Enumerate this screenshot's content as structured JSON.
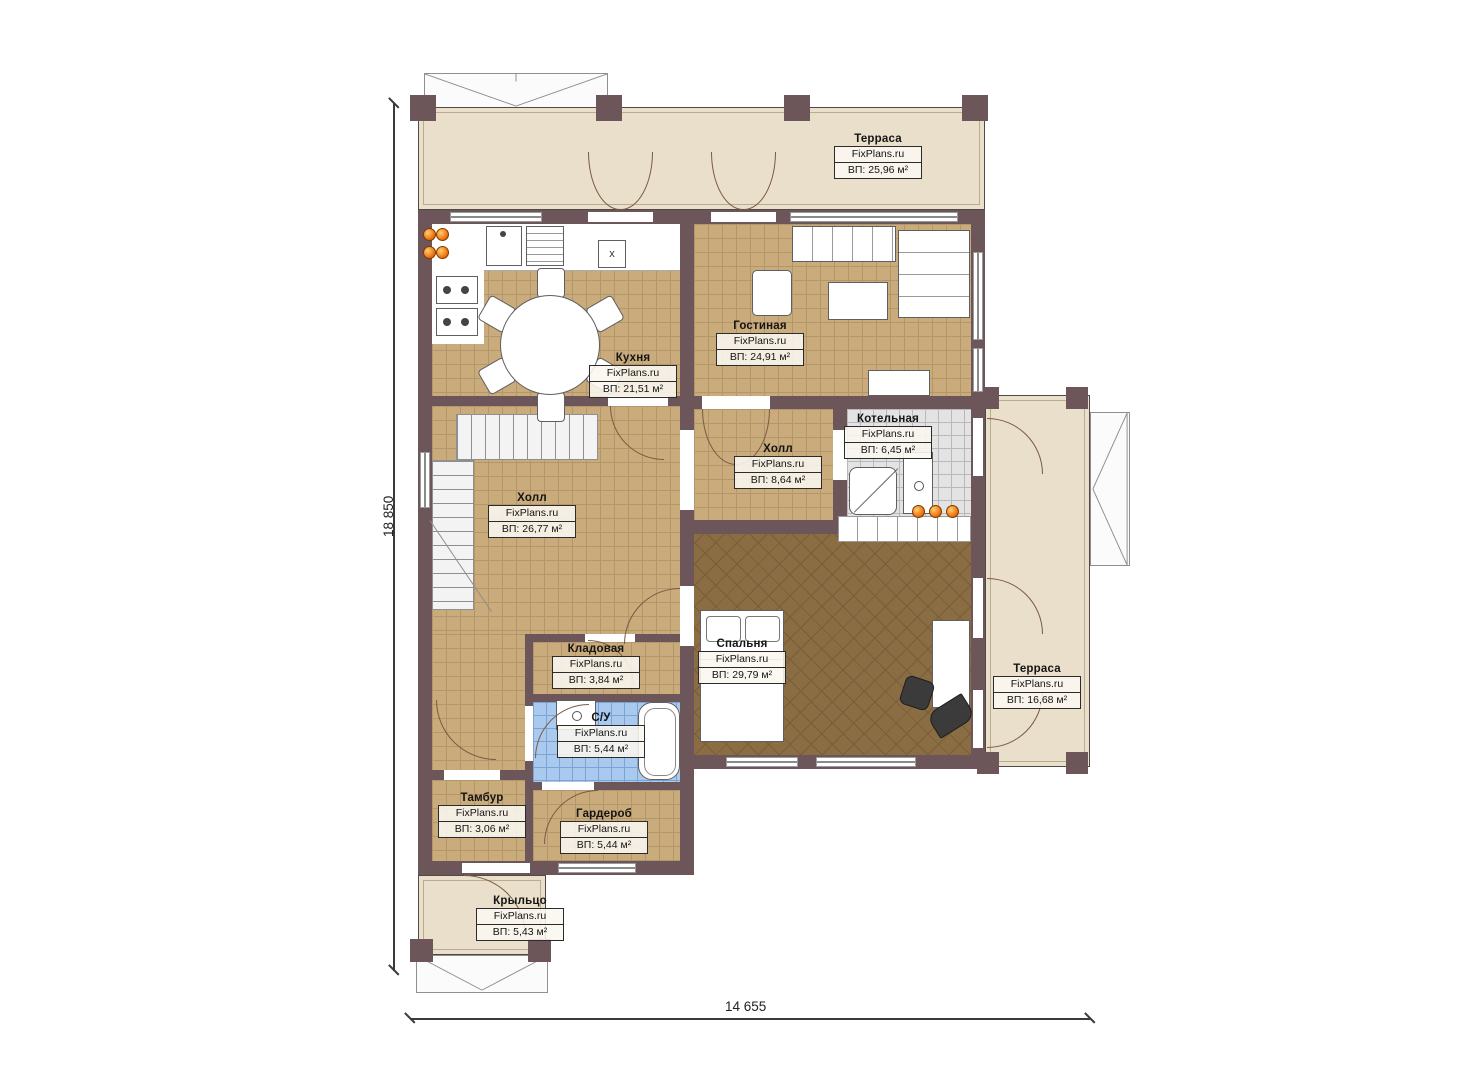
{
  "rooms": {
    "terrace_top": {
      "name": "Терраса",
      "site": "FixPlans.ru",
      "area": "ВП: 25,96 м²"
    },
    "kitchen": {
      "name": "Кухня",
      "site": "FixPlans.ru",
      "area": "ВП: 21,51 м²"
    },
    "living": {
      "name": "Гостиная",
      "site": "FixPlans.ru",
      "area": "ВП: 24,91 м²"
    },
    "boiler": {
      "name": "Котельная",
      "site": "FixPlans.ru",
      "area": "ВП: 6,45 м²"
    },
    "hall_small": {
      "name": "Холл",
      "site": "FixPlans.ru",
      "area": "ВП: 8,64 м²"
    },
    "hall_main": {
      "name": "Холл",
      "site": "FixPlans.ru",
      "area": "ВП: 26,77 м²"
    },
    "bedroom": {
      "name": "Спальня",
      "site": "FixPlans.ru",
      "area": "ВП: 29,79 м²"
    },
    "storage": {
      "name": "Кладовая",
      "site": "FixPlans.ru",
      "area": "ВП: 3,84 м²"
    },
    "bathroom": {
      "name": "С/У",
      "site": "FixPlans.ru",
      "area": "ВП: 5,44 м²"
    },
    "vestibule": {
      "name": "Тамбур",
      "site": "FixPlans.ru",
      "area": "ВП: 3,06 м²"
    },
    "wardrobe": {
      "name": "Гардероб",
      "site": "FixPlans.ru",
      "area": "ВП: 5,44 м²"
    },
    "porch": {
      "name": "Крыльцо",
      "site": "FixPlans.ru",
      "area": "ВП: 5,43 м²"
    },
    "terrace_right": {
      "name": "Терраса",
      "site": "FixPlans.ru",
      "area": "ВП: 16,68 м²"
    }
  },
  "dimensions": {
    "height": "18 850",
    "width": "14 655"
  },
  "misc": {
    "fan_marker": "x"
  },
  "colors": {
    "wall": "#6d5659",
    "floor_tan": "#c9ab7c",
    "floor_bedroom": "#8b6d44",
    "tile_blue": "#a9c9ee",
    "tile_grey": "#e3e3e3",
    "terrace": "#e9dfca",
    "accent_orange": "#f07814"
  }
}
